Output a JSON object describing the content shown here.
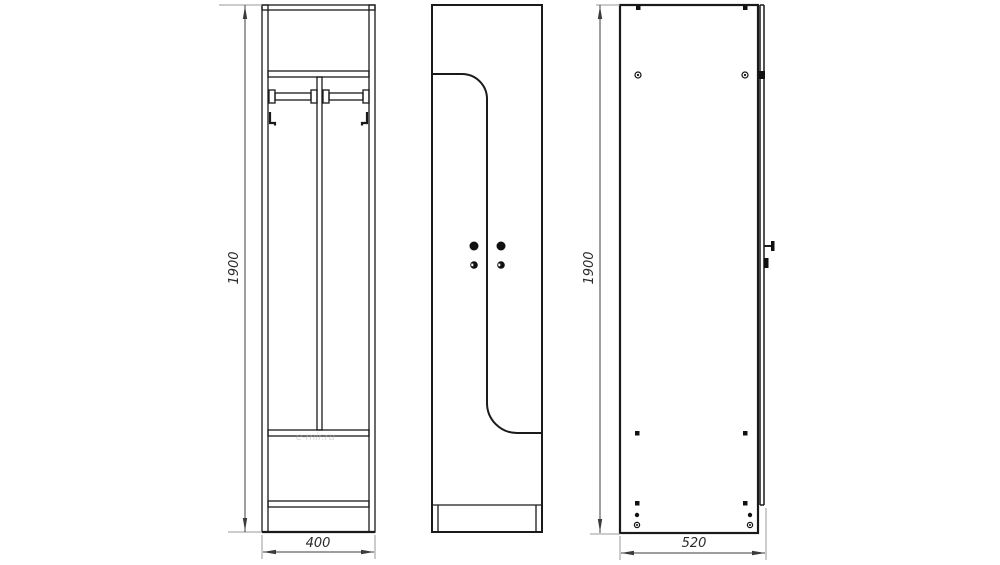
{
  "dimensions": {
    "front_height": "1900",
    "front_width": "400",
    "side_height": "1900",
    "side_depth": "520"
  },
  "watermark": {
    "text": "e-mir.ru"
  },
  "colors": {
    "line": "#1a1a1a",
    "dim_line": "#3c3c3c",
    "extension_line": "#9a9a9a",
    "background": "#ffffff"
  }
}
